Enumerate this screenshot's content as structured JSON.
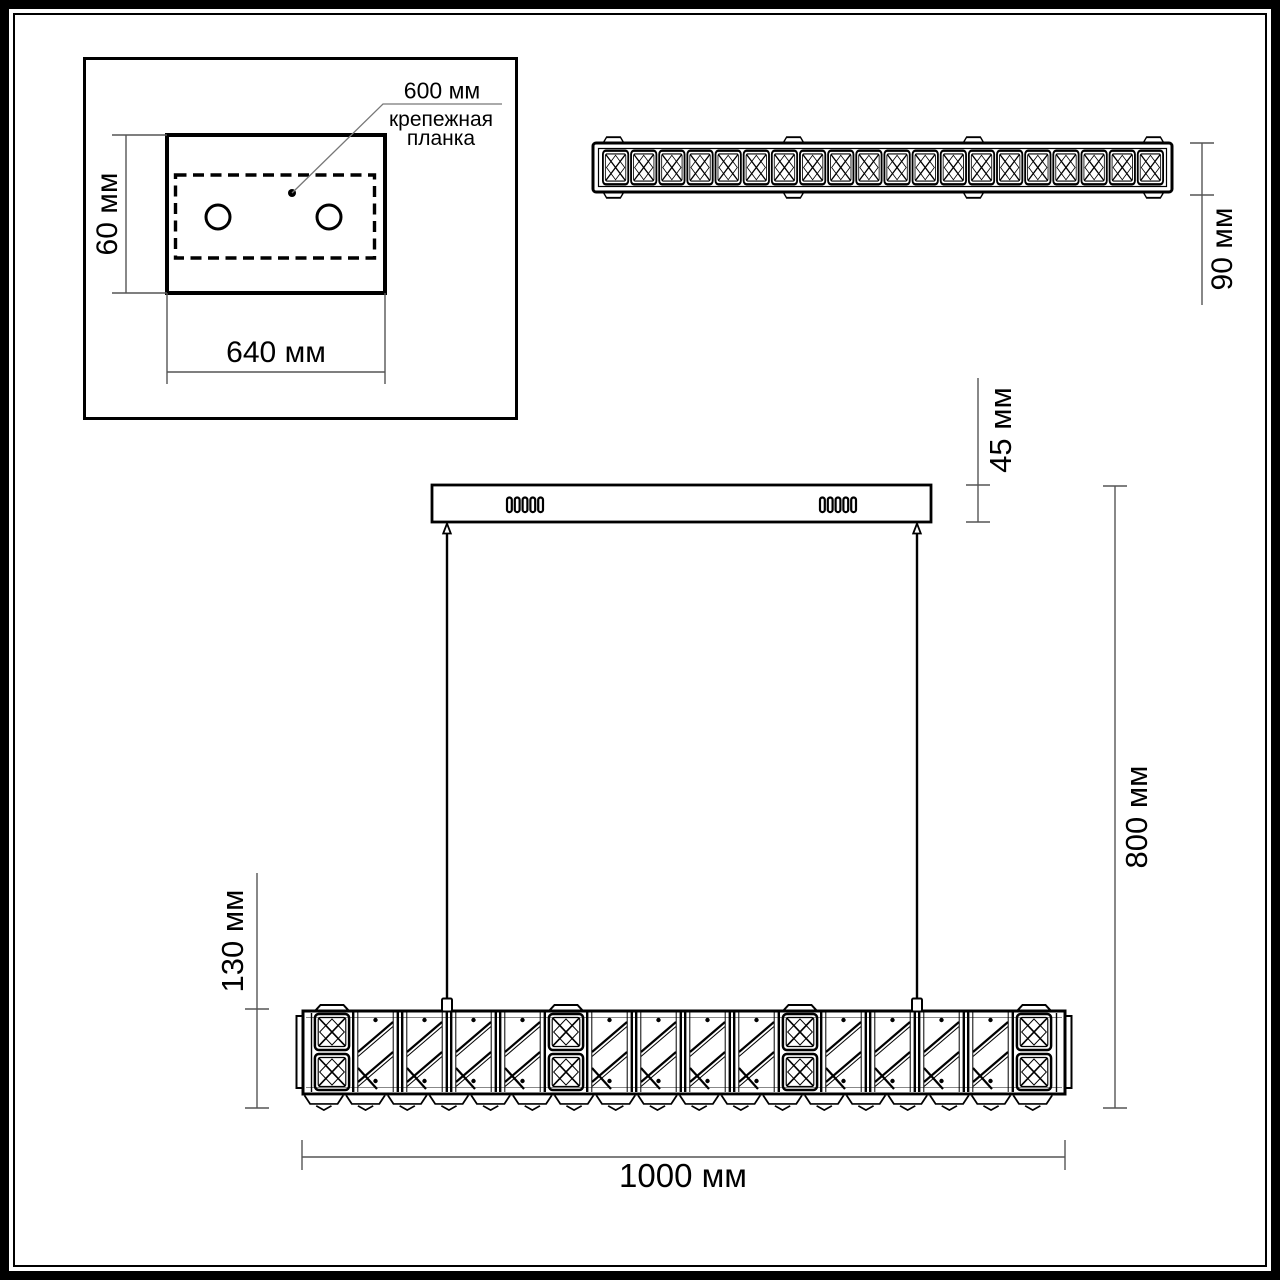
{
  "page": {
    "background": "#ffffff",
    "line_color": "#000000",
    "dim_line_color": "#555555"
  },
  "inset_plate_view": {
    "hole_spacing_label": "600 мм",
    "mount_bar_label": "крепежная\nпланка",
    "plate_height_label": "60 мм",
    "plate_width_label": "640 мм"
  },
  "side_view": {
    "bar_height_label": "90 мм"
  },
  "front_view": {
    "canopy_height_label": "45 мм",
    "suspension_drop_label": "800 мм",
    "bar_height_label": "130 мм",
    "bar_width_label": "1000 мм"
  }
}
